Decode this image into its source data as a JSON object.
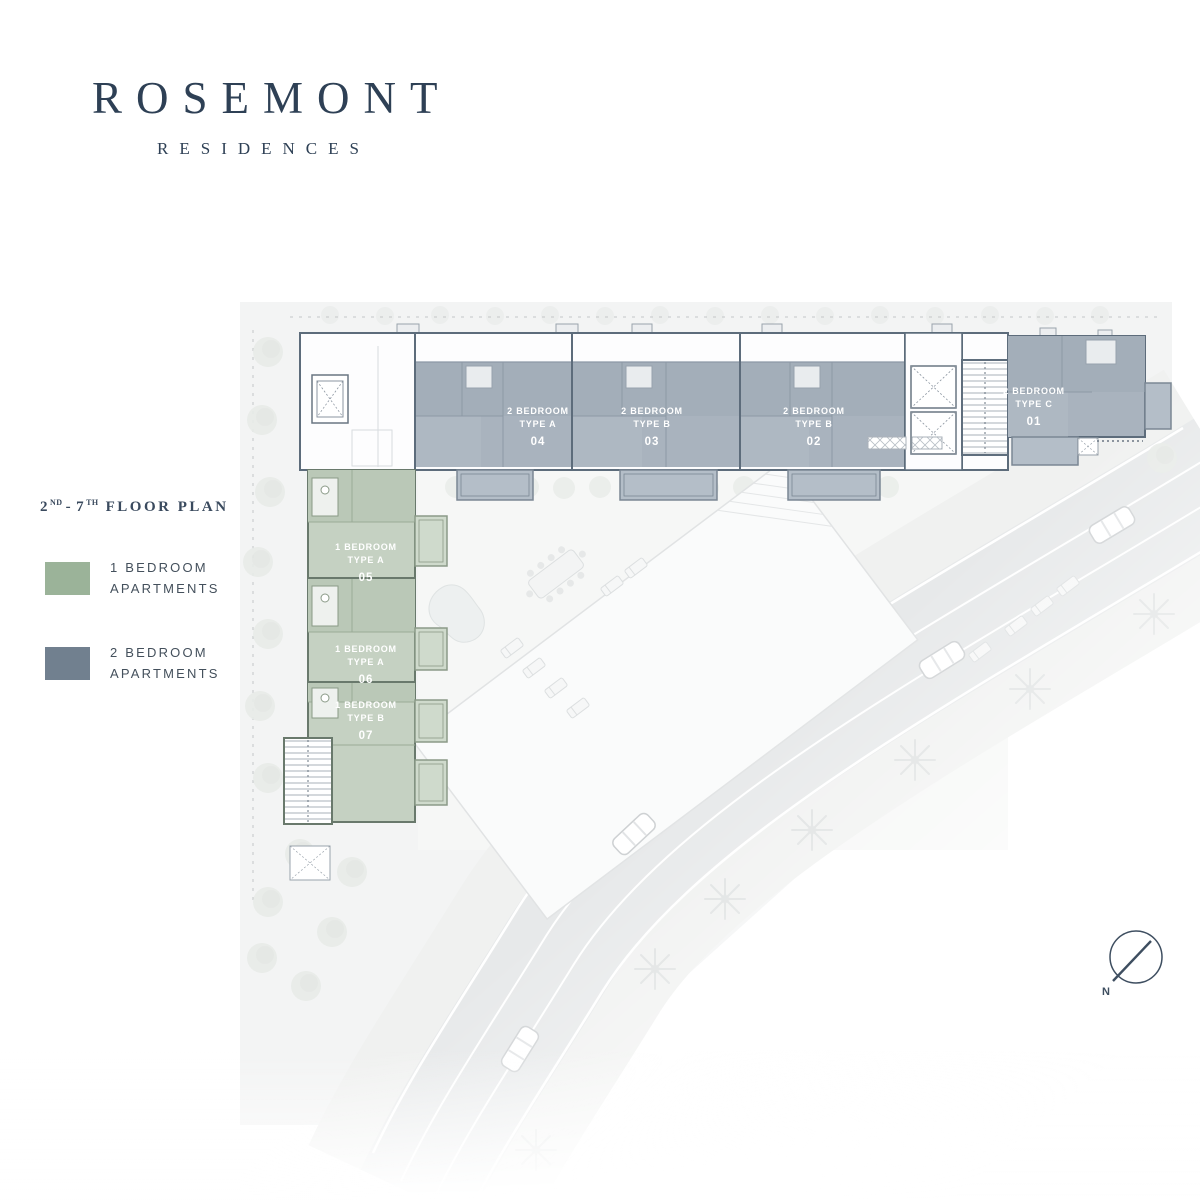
{
  "brand": {
    "name": "ROSEMONT",
    "tagline": "RESIDENCES"
  },
  "plan": {
    "title": {
      "floor_start": "2",
      "floor_start_suffix": "ND",
      "separator": "-",
      "floor_end": "7",
      "floor_end_suffix": "TH",
      "text": "FLOOR PLAN"
    },
    "legend": [
      {
        "label_line1": "1 BEDROOM",
        "label_line2": "APARTMENTS",
        "color": "#9bb399"
      },
      {
        "label_line1": "2 BEDROOM",
        "label_line2": "APARTMENTS",
        "color": "#71808f"
      }
    ],
    "units": [
      {
        "bedrooms": "2 BEDROOM",
        "type": "TYPE A",
        "number": "04",
        "category": "2-bedroom"
      },
      {
        "bedrooms": "2 BEDROOM",
        "type": "TYPE B",
        "number": "03",
        "category": "2-bedroom"
      },
      {
        "bedrooms": "2 BEDROOM",
        "type": "TYPE B",
        "number": "02",
        "category": "2-bedroom"
      },
      {
        "bedrooms": "2 BEDROOM",
        "type": "TYPE C",
        "number": "01",
        "category": "2-bedroom"
      },
      {
        "bedrooms": "1 BEDROOM",
        "type": "TYPE A",
        "number": "05",
        "category": "1-bedroom"
      },
      {
        "bedrooms": "1 BEDROOM",
        "type": "TYPE A",
        "number": "06",
        "category": "1-bedroom"
      },
      {
        "bedrooms": "1 BEDROOM",
        "type": "TYPE B",
        "number": "07",
        "category": "1-bedroom"
      }
    ],
    "compass": {
      "label": "N"
    }
  },
  "colors": {
    "brand_navy": "#2e4055",
    "one_bedroom_green": "#9bb399",
    "two_bedroom_blue": "#71808f",
    "unit_fill_1br": "#c5d1c2",
    "unit_fill_2br": "#a9b3be"
  }
}
